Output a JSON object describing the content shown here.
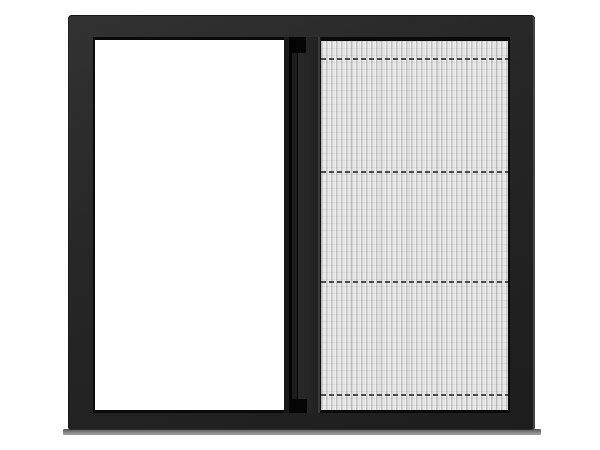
{
  "scene": {
    "description": "Product photo of a dark anthracite sliding window: open white pane on the left, pleated insect screen mesh covering the right half, vertical handle rail in the middle, thin gray sill shadow at the base",
    "objects": [
      "window-frame",
      "open-pane",
      "center-rail",
      "pleated-screen",
      "tension-cords",
      "window-sill"
    ]
  },
  "colors": {
    "background": "#ffffff",
    "frame_light": "#323232",
    "frame_face": "#262626",
    "frame_dark": "#1d1d1d",
    "frame_highlight": "#454545",
    "reveal_shadow": "#0a0a0a",
    "pane_white": "#ffffff",
    "rail_dark": "#181818",
    "rail_seam": "#020202",
    "rail_mid": "#1d1d1d",
    "rail_face": "#292929",
    "rail_face2": "#222222",
    "rail_highlight": "#3a3a3a",
    "rail_edge": "#101010",
    "notch": "#050505",
    "screen_edge": "#0b0b0b",
    "mesh_base": "#e9e9e9",
    "pleat_dark": "#c2c2c2",
    "pleat_mid": "#d8d8d8",
    "pleat_light": "#efefef",
    "cord": "#4a4a4a",
    "sill_top": "#565656",
    "sill_bottom": "#9b9b9b"
  },
  "screen": {
    "pleat_period_px": 5,
    "cord_positions_px": [
      21,
      134,
      244,
      357
    ],
    "cord_dash_px": 5,
    "cord_gap_px": 3
  }
}
